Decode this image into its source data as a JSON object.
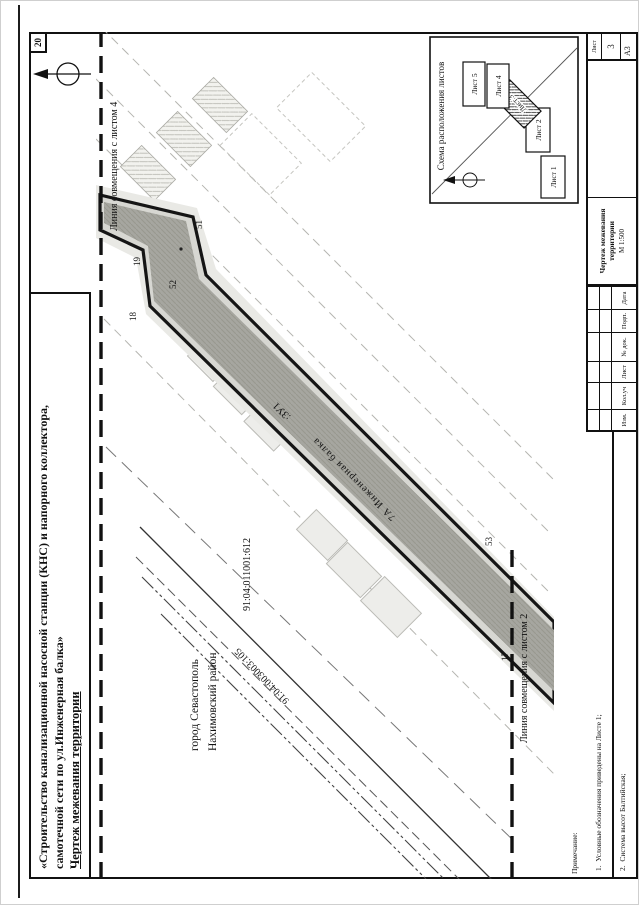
{
  "banner": {
    "line1": "«Строительство канализационной насосной станции (КНС) и напорного коллектора,",
    "line2": "самотечной сети по ул.Инженерная балка»",
    "line3": "Чертеж межевания территории"
  },
  "corner_number": "20",
  "format_label": "А3",
  "map": {
    "match_top": "Линия совмещения с листом 4",
    "match_bottom": "Линия совмещения с листом 2",
    "parcel_label": ":ЗУ1",
    "street_label": "7А Инженерная балка",
    "cadastral_right": "91:04:011001:612",
    "cadastral_line": "91:04:003003:105",
    "city_line1": "город Севастополь",
    "city_line2": "Нахимовский район",
    "points": {
      "p17": "17",
      "p18": "18",
      "p19": "19",
      "p51": "51",
      "p52": "52",
      "p53": "53"
    }
  },
  "scheme": {
    "title": "Схема расположения листов",
    "sheet1": "Лист 1",
    "sheet2": "Лист 2",
    "sheet3": "Лист 3",
    "sheet4": "Лист 4",
    "sheet5": "Лист 5"
  },
  "notes": {
    "heading": "Примечание:",
    "item1": "1.  Условные обозначения приведены на Листе 1;",
    "item2": "2.  Система высот Балтийская;",
    "item3": "3.  Система координат СК-63."
  },
  "stamp": {
    "col_izm": "Изм.",
    "col_koluch": "Кол.уч",
    "col_list": "Лист",
    "col_ndok": "№ док.",
    "col_podp": "Подп.",
    "col_data": "Дата",
    "doc_title": "Чертеж межевания территории",
    "scale": "М 1:500",
    "sheet_label": "Лист",
    "sheet_number": "3"
  }
}
